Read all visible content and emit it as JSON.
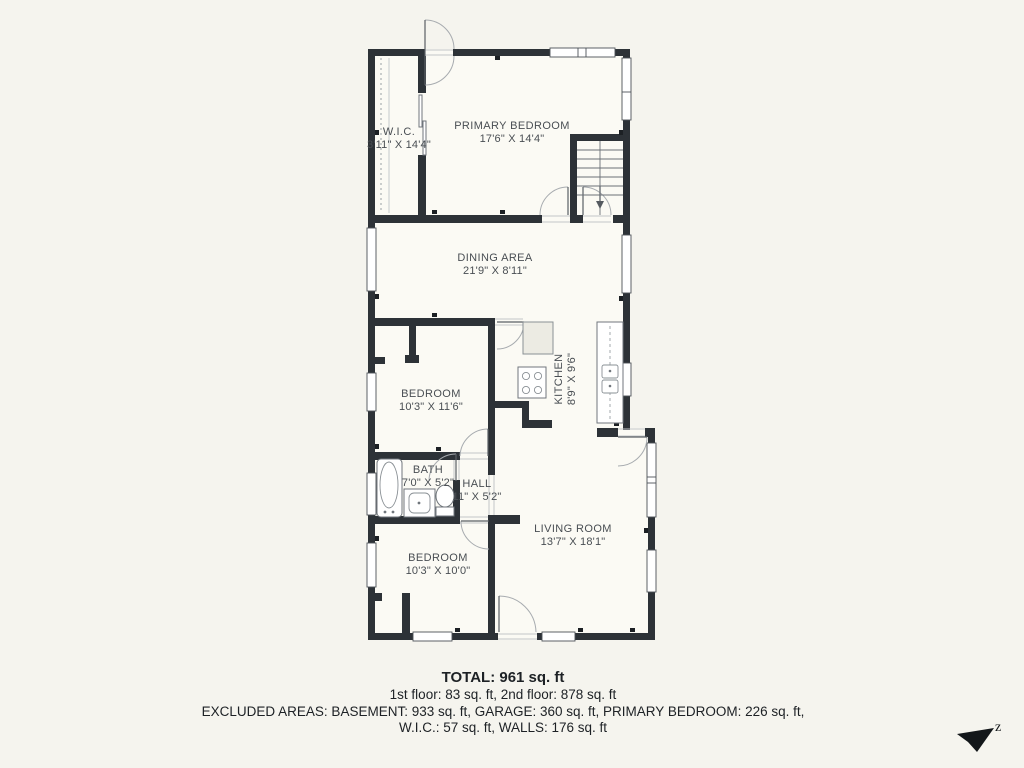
{
  "floor_plan": {
    "rooms": [
      {
        "id": "wic",
        "name": "W.I.C.",
        "dims": "3'11\" X 14'4\""
      },
      {
        "id": "primary_bedroom",
        "name": "PRIMARY BEDROOM",
        "dims": "17'6\" X 14'4\""
      },
      {
        "id": "dining_area",
        "name": "DINING AREA",
        "dims": "21'9\" X 8'11\""
      },
      {
        "id": "bedroom_middle",
        "name": "BEDROOM",
        "dims": "10'3\" X 11'6\""
      },
      {
        "id": "kitchen",
        "name": "KITCHEN",
        "dims": "8'9\" X 9'6\""
      },
      {
        "id": "bath",
        "name": "BATH",
        "dims": "7'0\" X 5'2\""
      },
      {
        "id": "hall",
        "name": "HALL",
        "dims": "11\" X 5'2\""
      },
      {
        "id": "living_room",
        "name": "LIVING ROOM",
        "dims": "13'7\" X 18'1\""
      },
      {
        "id": "bedroom_bottom",
        "name": "BEDROOM",
        "dims": "10'3\" X 10'0\""
      }
    ],
    "summary": {
      "total": "TOTAL: 961 sq. ft",
      "floors": "1st floor: 83 sq. ft, 2nd floor: 878 sq. ft",
      "excluded_line1": "EXCLUDED AREAS: BASEMENT: 933 sq. ft, GARAGE: 360 sq. ft, PRIMARY BEDROOM: 226 sq. ft,",
      "excluded_line2": "W.I.C.: 57 sq. ft, WALLS: 176 sq. ft"
    },
    "compass": {
      "label": "z"
    },
    "colors": {
      "background": "#f5f4ee",
      "walls": "#2d3237",
      "floor": "#fbfaf4",
      "label_text": "#494e53"
    }
  }
}
